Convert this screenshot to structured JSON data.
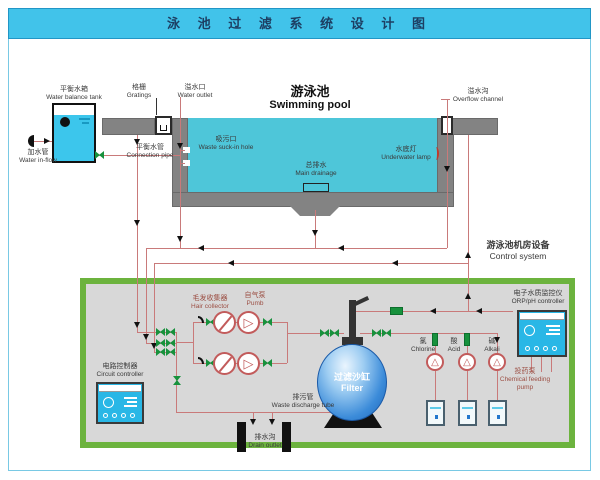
{
  "title": "泳 池 过 滤 系 统 设 计 图",
  "colors": {
    "header_bg": "#41c3ea",
    "pool_water": "#4ec6d9",
    "pipe": "#c97a7a",
    "valve_green": "#17913c",
    "room_border": "#6cb33e",
    "concrete": "#838383",
    "controller_blue": "#29b7e6",
    "filter_blue": "#1d63b5"
  },
  "labels": {
    "balance_tank_zh": "平衡水箱",
    "balance_tank_en": "Water balance tank",
    "inflow_zh": "加水管",
    "inflow_en": "Water in-flow",
    "gratings_zh": "格栅",
    "gratings_en": "Gratings",
    "outlet_zh": "溢水口",
    "outlet_en": "Water outlet",
    "conn_zh": "平衡水管",
    "conn_en": "Connection pipe",
    "pool_zh": "游泳池",
    "pool_en": "Swimming pool",
    "suck_zh": "吸污口",
    "suck_en": "Waste suck-in hole",
    "drainage_zh": "总排水",
    "drainage_en": "Main drainage",
    "lamp_zh": "水底灯",
    "lamp_en": "Underwater lamp",
    "overflow_zh": "溢水沟",
    "overflow_en": "Overflow channel",
    "room_zh": "游泳池机房设备",
    "room_en": "Control system",
    "hair_zh": "毛发收集器",
    "hair_en": "Hair collector",
    "pump_zh": "自气泵",
    "pump_en": "Pumb",
    "circuit_zh": "电路控制器",
    "circuit_en": "Circuit controller",
    "filter_zh": "过滤沙缸",
    "filter_en": "Filter",
    "waste_zh": "排污管",
    "waste_en": "Waste discharge tube",
    "drainout_zh": "排水沟",
    "drainout_en": "Drain outlet",
    "chlorine_zh": "氯",
    "chlorine_en": "Chlorine",
    "acid_zh": "酸",
    "acid_en": "Acid",
    "alkali_zh": "碱",
    "alkali_en": "Alkali",
    "feedpump_zh": "投药泵",
    "feedpump_en": "Chemical feeding pump",
    "orp_zh": "电子水质监控仪",
    "orp_en": "ORP/pH controller"
  }
}
